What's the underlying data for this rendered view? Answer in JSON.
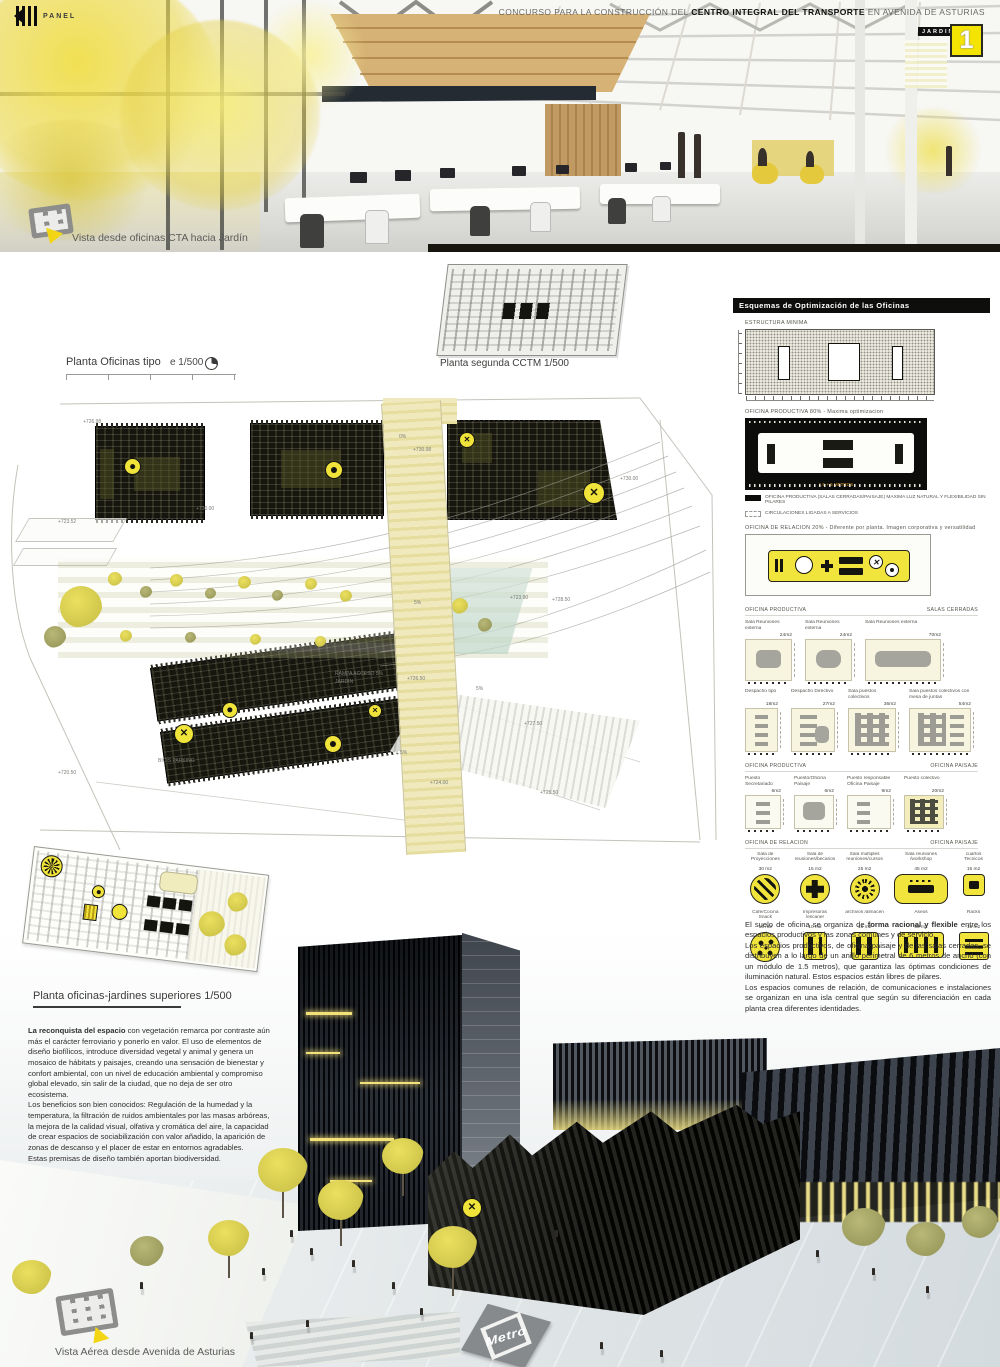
{
  "header": {
    "brand": "PANEL",
    "title_prefix": "CONCURSO PARA LA CONSTRUCCIÓN DEL ",
    "title_bold": "CENTRO INTEGRAL DEL TRANSPORTE",
    "title_suffix": " EN AVENIDA DE ASTURIAS",
    "jardin_tag": "JARDIN",
    "panel_number": "1"
  },
  "captions": {
    "top_view": "Vista desde oficinas CTA hacia Jardín",
    "bottom_view": "Vista Aérea desde Avenida de Asturias"
  },
  "plan_labels": {
    "oficinas_tipo": "Planta Oficinas tipo",
    "oficinas_tipo_scale": "e 1/500",
    "segunda_cctm": "Planta segunda CCTM  1/500",
    "jardines": "Planta oficinas-jardines superiores  1/500"
  },
  "siteplan": {
    "labels": [
      {
        "t": "+726.98",
        "x": 83,
        "y": 29
      },
      {
        "t": "+723.52",
        "x": 58,
        "y": 129
      },
      {
        "t": "+730.00",
        "x": 196,
        "y": 116
      },
      {
        "t": "0%",
        "x": 399,
        "y": 44
      },
      {
        "t": "+730.98",
        "x": 413,
        "y": 57
      },
      {
        "t": "+730.00",
        "x": 620,
        "y": 86
      },
      {
        "t": "+723.90",
        "x": 510,
        "y": 205
      },
      {
        "t": "+728.50",
        "x": 552,
        "y": 207
      },
      {
        "t": "5%",
        "x": 414,
        "y": 210
      },
      {
        "t": "RAMPA ACCESO  5%",
        "x": 335,
        "y": 281
      },
      {
        "t": "JARDIN",
        "x": 335,
        "y": 289
      },
      {
        "t": "+726.50",
        "x": 407,
        "y": 286
      },
      {
        "t": "5%",
        "x": 476,
        "y": 296
      },
      {
        "t": "+727.50",
        "x": 524,
        "y": 331
      },
      {
        "t": "BICIS PARKING",
        "x": 158,
        "y": 368
      },
      {
        "t": "5%",
        "x": 400,
        "y": 360
      },
      {
        "t": "+724.00",
        "x": 430,
        "y": 390
      },
      {
        "t": "+725.50",
        "x": 540,
        "y": 400
      },
      {
        "t": "+720.50",
        "x": 58,
        "y": 380
      }
    ]
  },
  "sidebar": {
    "title": "Esquemas de Optimización de las Oficinas",
    "estructura_label": "ESTRUCTURA MINIMA",
    "productiva_label": "OFICINA PRODUCTIVA 80% - Maxima optimizacion",
    "productiva_dim": "1.5 + 6 METROS",
    "legend": [
      {
        "text": "OFICINA PRODUCTIVA (SALAS CERRADAS/PAISAJE) MAXIMA LUZ NATURAL Y FLEXIBILIDAD SIN PILARES"
      },
      {
        "text": "CIRCULACIONES LIGADAS A SERVICIOS"
      }
    ],
    "relacion_label": "OFICINA DE RELACION 20% - Diferente por planta. Imagen corporativa y versatilidad",
    "sec1": {
      "left": "OFICINA PRODUCTIVA",
      "right": "SALAS CERRADAS"
    },
    "rooms_row1": [
      {
        "name": "Sala Reuniones externa",
        "area": "24m2"
      },
      {
        "name": "Sala Reuniones externa",
        "area": "24m2"
      },
      {
        "name": "Sala Reuniones externa",
        "area": "70m2"
      }
    ],
    "rooms_row2": [
      {
        "name": "Despacho tipo",
        "area": "18m2"
      },
      {
        "name": "Despacho Directivo",
        "area": "27m2"
      },
      {
        "name": "Sala puestos colectivos",
        "area": "36m2"
      },
      {
        "name": "Sala puestos colectivos con mesa de juntas",
        "area": "54m2"
      }
    ],
    "sec2": {
      "left": "OFICINA PRODUCTIVA",
      "right": "OFICINA PAISAJE"
    },
    "rooms_row3": [
      {
        "name": "Puesto Secretariado",
        "area": "6m2"
      },
      {
        "name": "Puesto/Oficina Paisaje",
        "area": "6m2"
      },
      {
        "name": "Puesto responsable Oficina Paisaje",
        "area": "9m2"
      },
      {
        "name": "Puesto colectivo",
        "area": "20m2"
      }
    ],
    "sec3": {
      "left": "OFICINA DE RELACION",
      "right": "OFICINA PAISAJE"
    },
    "icons_row1": [
      {
        "name": "Sala de Proyecciones",
        "area": "30 m2"
      },
      {
        "name": "Sala de reuniones/becarios",
        "area": "15 m2"
      },
      {
        "name": "Sala multiples reuniones/cursos",
        "area": "25 m2"
      },
      {
        "name": "Sala reuniones /workshop",
        "area": "45 m2"
      },
      {
        "name": "cuartos Tecnicos",
        "area": "15 m2"
      }
    ],
    "icons_row2": [
      {
        "name": "Cafe/Cocina Snack",
        "area": "16 m2"
      },
      {
        "name": "Impresoras /escaner",
        "area": "10 m2"
      },
      {
        "name": "archivos /almacen",
        "area": "16 m2"
      },
      {
        "name": "Aseos",
        "area": "30 m2"
      },
      {
        "name": "Racks",
        "area": "15 m2"
      }
    ],
    "paragraph": {
      "p1_pre": "El suelo de oficina se organiza de ",
      "p1_bold": "forma racional y flexible",
      "p1_post": " entre los espacios productivos y las zonas comunes y de servicio.",
      "p2": "Los espacios productivos, de oficina paisaje y de las salas cerradas, se distribuyen a lo largo de un anillo perimetral de 6 metros de ancho (con un módulo de 1.5 metros), que garantiza las óptimas condiciones de iluminación natural. Estos espacios están libres de pilares.",
      "p3": "Los espacios comunes de relación, de comunicaciones e instalaciones se organizan en una isla central que según su diferenciación en cada planta crea diferentes identidades."
    }
  },
  "left_text": {
    "p1_bold": "La reconquista del espacio",
    "p1_rest": " con vegetación remarca por contraste aún más el carácter ferroviario y ponerlo en valor. El uso de elementos de diseño biofílicos, introduce diversidad vegetal y animal y genera un mosaico de hábitats y paisajes, creando una sensación de bienestar y confort ambiental, con un nivel de educación ambiental y compromiso global elevado, sin salir de la ciudad, que no deja de ser otro ecosistema.",
    "p2": " Los beneficios son bien conocidos: Regulación de la humedad y la temperatura, la filtración de ruidos ambientales por las masas arbóreas, la mejora de la calidad visual, olfativa y cromática del aire, la capacidad de crear espacios de sociabilización con valor añadido, la aparición de zonas de descanso y el placer de estar en entornos agradables.",
    "p3": "Estas premisas de diseño también aportan biodiversidad."
  },
  "bottom": {
    "metro_label": "Metro"
  },
  "colors": {
    "accent_yellow": "#f2e430",
    "panel_black": "#111111",
    "ramp_beige": "#efe9bd"
  }
}
